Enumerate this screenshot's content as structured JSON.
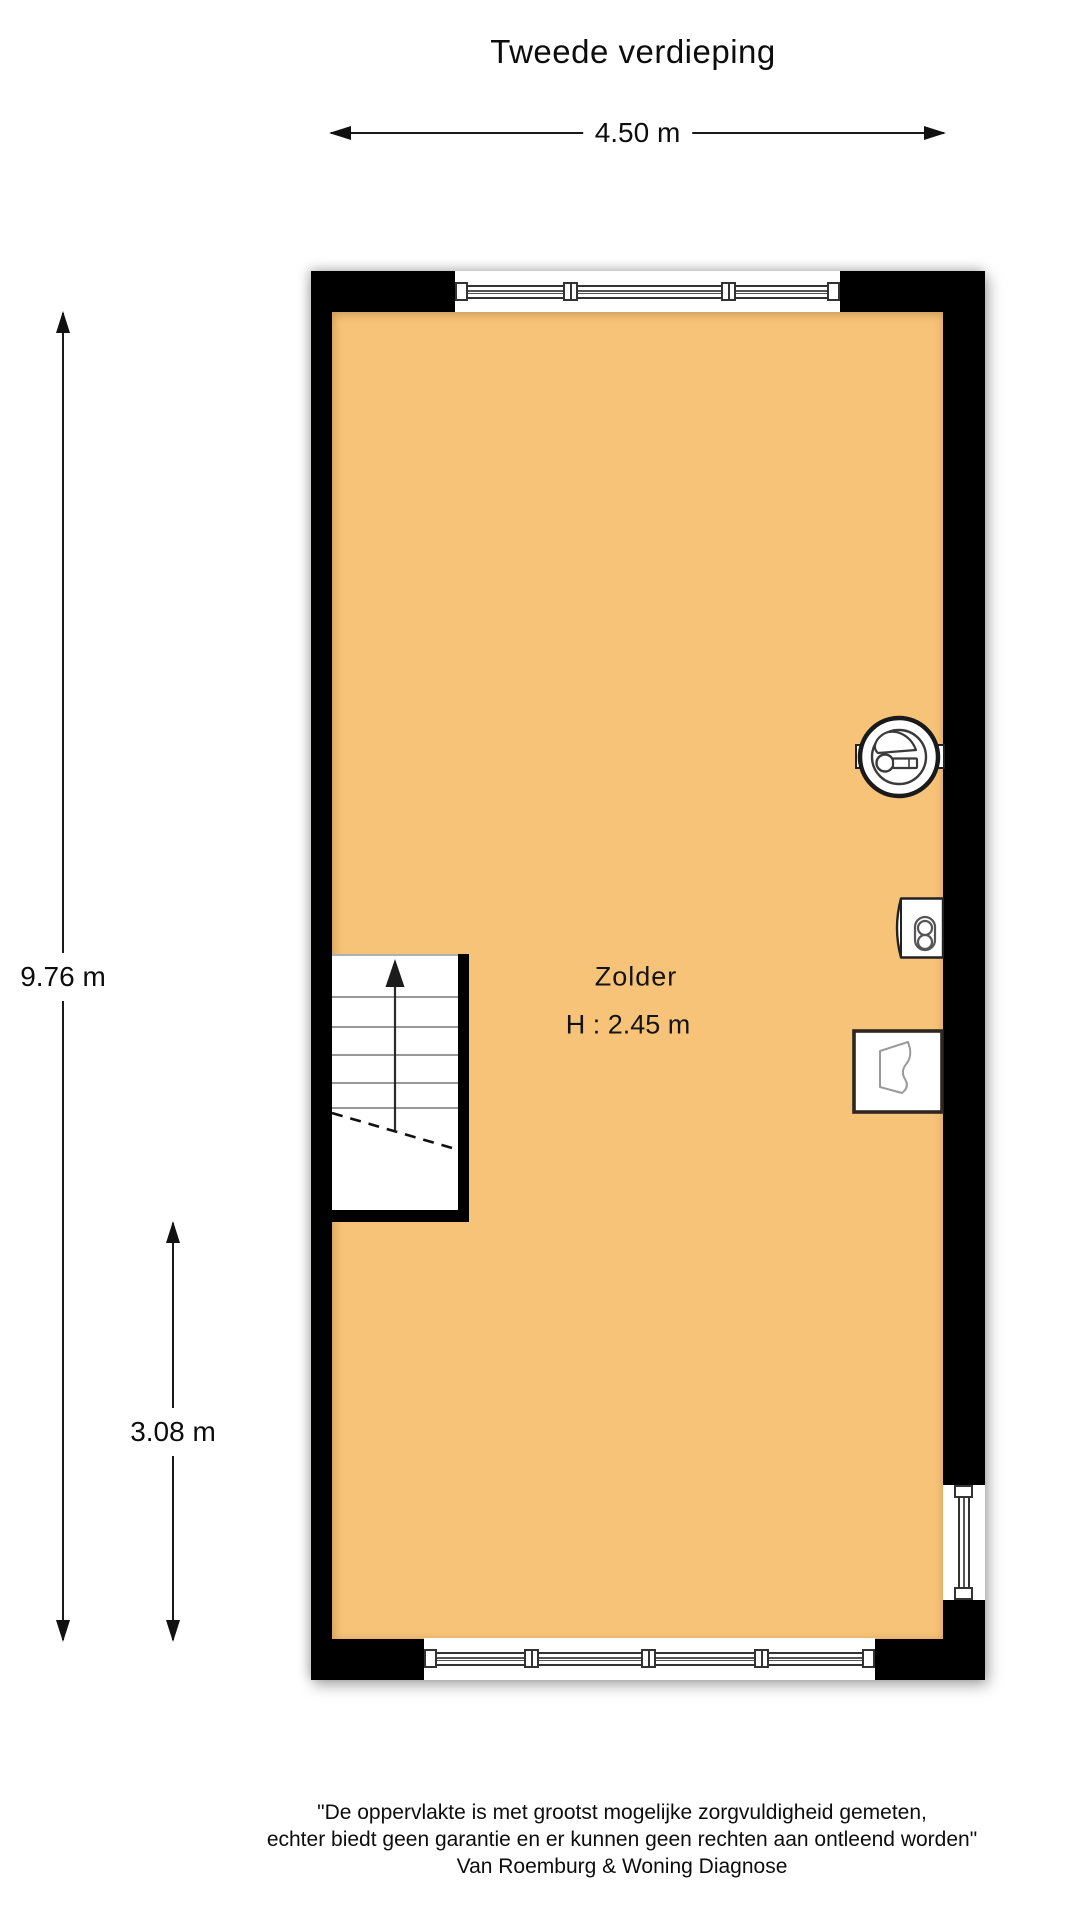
{
  "title": "Tweede verdieping",
  "dimensions": {
    "width": "4.50 m",
    "height_total": "9.76 m",
    "height_lower": "3.08 m"
  },
  "room": {
    "name": "Zolder",
    "ceiling_height": "H : 2.45 m"
  },
  "icons": {
    "stairs": "staircase-up-arrow",
    "fan": "mechanical-ventilation-fan",
    "boiler": "boiler-unit",
    "sink": "washbasin"
  },
  "colors": {
    "floor_fill": "#f6c379",
    "wall": "#000000",
    "detail_line": "#555555"
  },
  "footer": {
    "disclaimer_line1": "\"De oppervlakte is met grootst mogelijke zorgvuldigheid gemeten,",
    "disclaimer_line2": "echter biedt geen garantie en er kunnen geen rechten aan ontleend worden\"",
    "company": "Van Roemburg & Woning Diagnose"
  }
}
